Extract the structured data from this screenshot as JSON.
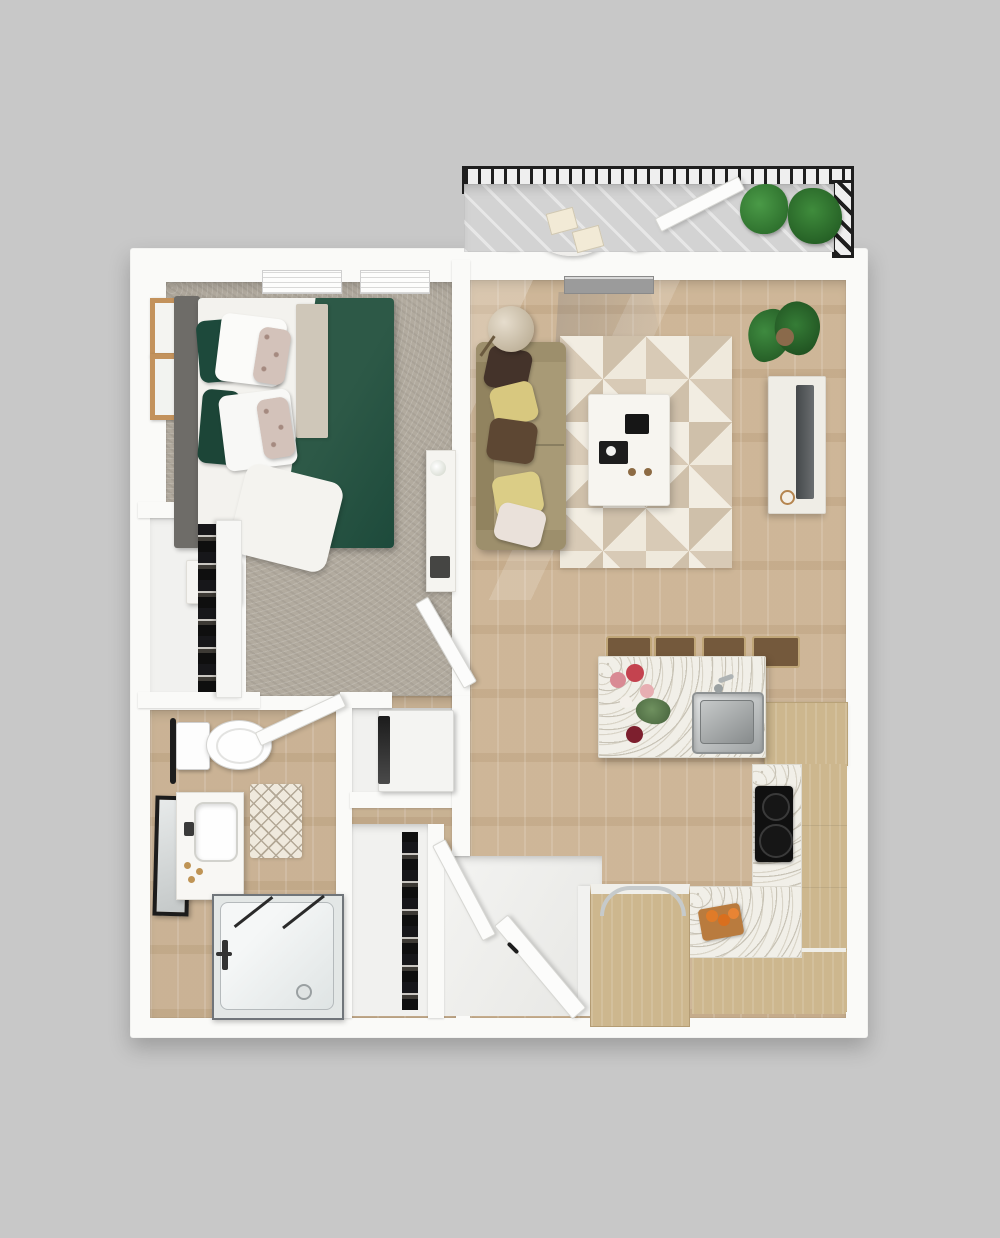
{
  "scene": {
    "type": "3d-floor-plan-top-view",
    "description": "One-bedroom, one-bathroom apartment 3D floor plan with balcony",
    "rooms": [
      {
        "name": "balcony",
        "items": [
          "metal-railing",
          "bistro-table",
          "cafe-chair",
          "cafe-chair",
          "place-setting",
          "place-setting",
          "potted-plant",
          "potted-plant",
          "balcony-door"
        ]
      },
      {
        "name": "bedroom",
        "items": [
          "window",
          "window",
          "wall-art",
          "wall-art",
          "queen-bed",
          "green-duvet",
          "pillows",
          "nightstand",
          "clock",
          "dresser",
          "bedroom-door",
          "carpet-floor"
        ]
      },
      {
        "name": "closet",
        "items": [
          "sliding-door-wardrobe",
          "hanging-clothes"
        ]
      },
      {
        "name": "bathroom",
        "items": [
          "toilet",
          "towel-bar",
          "vanity-sink",
          "leaning-mirror",
          "bath-mat",
          "tub-shower",
          "glass-panel",
          "faucet",
          "bathroom-door"
        ]
      },
      {
        "name": "hallway",
        "items": [
          "washer-dryer",
          "linen-closet",
          "entry-door",
          "closet-door"
        ]
      },
      {
        "name": "living-room",
        "items": [
          "floor-lamp",
          "sofa",
          "throw-pillows",
          "area-rug",
          "coffee-table",
          "remote",
          "serving-tray",
          "potted-plant",
          "tv-console",
          "tv",
          "sliding-door-threshold"
        ]
      },
      {
        "name": "kitchen",
        "items": [
          "peninsula-counter",
          "flowers-decor",
          "stainless-sink",
          "faucet",
          "bar-stool",
          "bar-stool",
          "bar-stool",
          "bar-stool",
          "tall-cabinet",
          "cooktop",
          "counter-l",
          "cutting-board",
          "island-cart",
          "dish-rack-handle"
        ]
      }
    ]
  },
  "palette": {
    "bg": "#c8c8c8",
    "wall": "#fafaf8",
    "carpet": "#b2ab9f",
    "wood": "#cbb292",
    "cabwood": "#cdb78e",
    "terrazzo": "#f1efe8",
    "balconyfloor": "#d3d3d3",
    "green": "#2d5947",
    "greendark": "#1d4a3b",
    "sofa": "#a89a76",
    "rugbase": "#e9e3d6",
    "rugdark": "#cfc0aa",
    "black": "#1a1a1a",
    "steel": "#aeb2b3",
    "plant": "#2f6d33",
    "plantdark": "#235427",
    "framewood": "#c3925c",
    "gold": "#bf9455",
    "pillowbrown": "#44332a",
    "pillowyellow": "#d8c87f",
    "pillowtan": "#5d4733"
  }
}
